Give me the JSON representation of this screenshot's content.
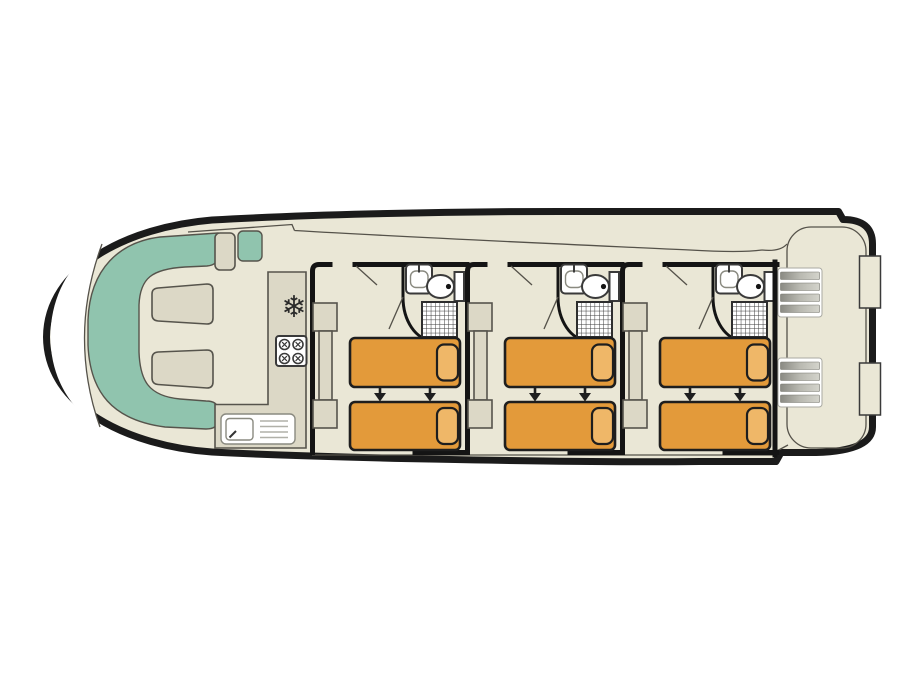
{
  "page": {
    "background": "#ffffff"
  },
  "diagram": {
    "type": "floor-plan",
    "subject": "houseboat-deck-plan",
    "areas": {
      "bow_lounge": {
        "tables": 2,
        "side_steps": 2
      },
      "galley": {
        "features": [
          "fridge-freezer-icon",
          "stove-4-burner",
          "sink-with-drainer"
        ]
      },
      "cabins": {
        "count": 3,
        "spacing": 155,
        "per_cabin": {
          "beds": 2,
          "bed_arrows": 2,
          "wardrobe": 1,
          "bathroom": {
            "sink": 1,
            "toilet": 1,
            "shower": 1
          }
        }
      },
      "stern_deck": {
        "stairs": 2,
        "stairs_spacing": 90,
        "boarding_gates": 2,
        "gates_spacing": 107
      }
    }
  },
  "glyphs": {
    "snowflake": "❄"
  },
  "colors": {
    "background": "#ffffff",
    "hull": "#1b1b1b",
    "deck": "#EAE7D6",
    "deck_line": "#55524A",
    "furniture": "#DCD8C6",
    "furniture_outline": "#56544C",
    "seating": "#90C4AE",
    "bed": "#E39A3A",
    "pillow": "#EFB768",
    "bed_outline": "#1e1e1e",
    "wall": "#141414",
    "fixture_fill": "#FFFFFF",
    "fixture_outline": "#3a3a3a",
    "arrow": "#1e1e1e"
  }
}
